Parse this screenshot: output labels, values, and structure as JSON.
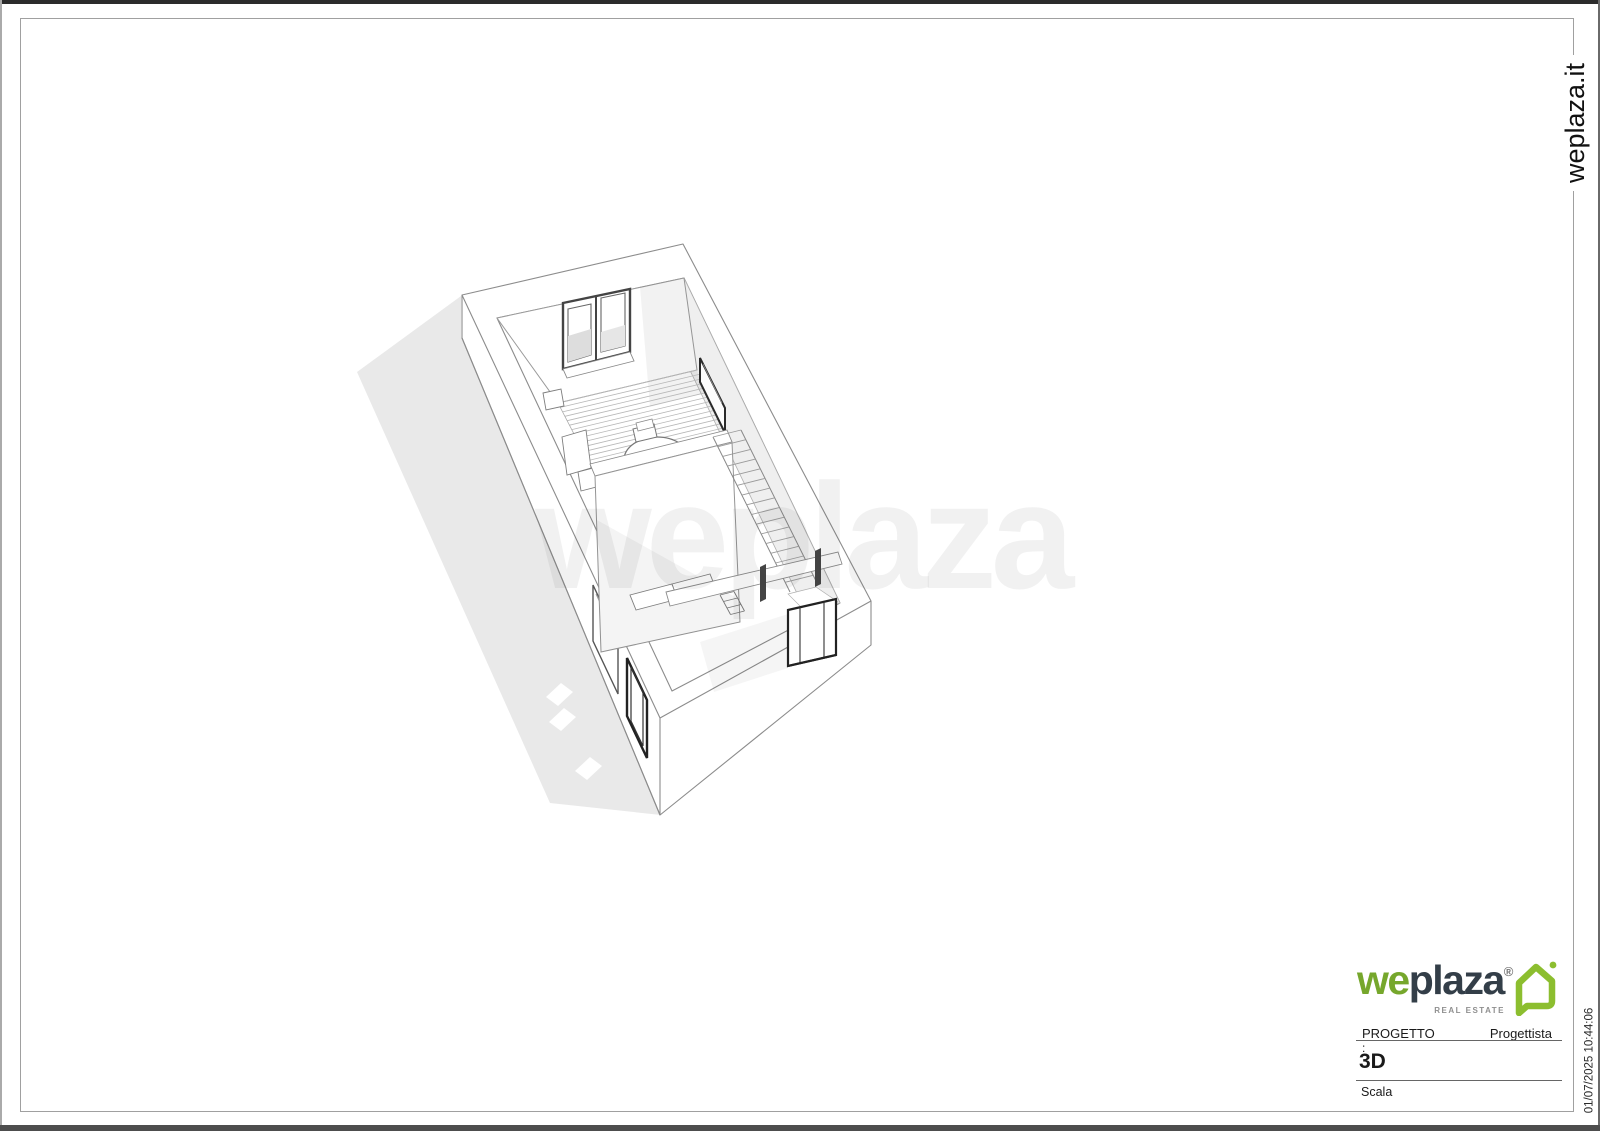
{
  "sheet": {
    "site_vertical_label": "weplaza.it",
    "print_timestamp": "01/07/2025 10:44:06"
  },
  "brand": {
    "name_part1": "we",
    "name_part2": "plaza",
    "registered_mark": "®",
    "tagline": "REAL ESTATE",
    "green": "#76A72C",
    "navy": "#333E48",
    "house_green": "#8CBE2F"
  },
  "title_block": {
    "project_label": "PROGETTO",
    "designer_label": "Progettista",
    "project_value": ":",
    "view_title": "3D",
    "scale_label": "Scala"
  },
  "drawing": {
    "kind": "3D axonometric apartment floor plan",
    "watermark": "weplaza"
  }
}
